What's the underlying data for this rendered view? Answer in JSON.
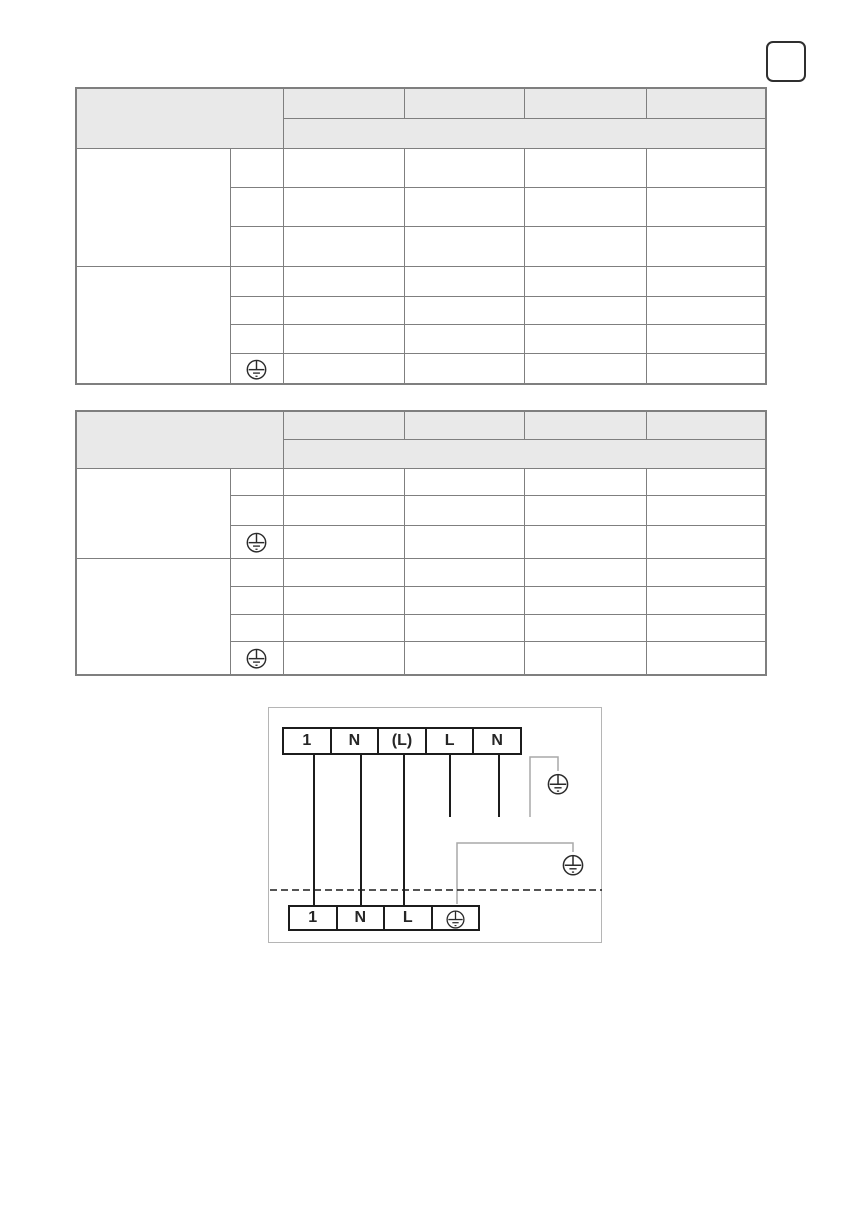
{
  "page": {
    "background": "#ffffff"
  },
  "page_number_box": {
    "value": ""
  },
  "colors": {
    "table_border": "#7f7f7f",
    "table_header_fill": "#e9e9e9",
    "terminal_border": "#1c1c1c",
    "wire_black": "#1c1c1c",
    "earth_wire_gray": "#a9a9a9",
    "diagram_frame": "#b5b5b5"
  },
  "upper_table": {
    "header": {
      "left_cell": "",
      "columns": [
        "",
        "",
        "",
        ""
      ],
      "merged_subheader": ""
    },
    "group1": {
      "label": "",
      "row_keys": [
        "",
        "",
        ""
      ],
      "data_cells": [
        "",
        "",
        "",
        ""
      ]
    },
    "group2": {
      "label": "",
      "row_keys": [
        "",
        "",
        "",
        "protective-earth-icon"
      ],
      "data_cells": [
        "",
        "",
        "",
        ""
      ]
    }
  },
  "lower_table": {
    "header": {
      "left_cell": "",
      "columns": [
        "",
        "",
        "",
        ""
      ],
      "merged_subheader": ""
    },
    "group1": {
      "label": "",
      "row_keys": [
        "",
        "",
        "protective-earth-icon"
      ],
      "data_cells": [
        "",
        "",
        "",
        ""
      ]
    },
    "group2": {
      "label": "",
      "row_keys": [
        "",
        "",
        "",
        "protective-earth-icon"
      ],
      "data_cells": [
        "",
        "",
        "",
        ""
      ]
    }
  },
  "diagram": {
    "top_terminals": [
      "1",
      "N",
      "(L)",
      "L",
      "N"
    ],
    "bottom_terminals": [
      "1",
      "N",
      "L"
    ],
    "bottom_terminal_icon": "protective-earth-icon",
    "ground_symbols": [
      "protective-earth-icon",
      "protective-earth-icon",
      "protective-earth-icon"
    ]
  }
}
